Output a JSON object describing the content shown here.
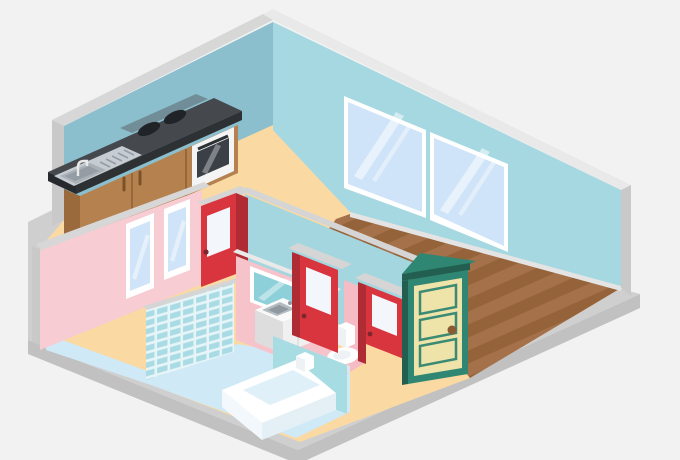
{
  "scene": {
    "description": "Isometric cutaway illustration of an apartment interior",
    "style": "flat vector isometric",
    "rooms": [
      {
        "name": "kitchen",
        "items": [
          "counter with steel sink and faucet",
          "two stove burners",
          "built-in oven",
          "brown cabinets"
        ]
      },
      {
        "name": "living-area",
        "items": [
          "hardwood plank floor",
          "double picture window"
        ]
      },
      {
        "name": "bathroom",
        "items": [
          "blue tiled accent wall",
          "bathtub",
          "toilet",
          "vanity sink cabinet",
          "wall mirror",
          "low partition wall",
          "two small windows"
        ]
      },
      {
        "name": "hallway",
        "items": [
          "red interior door 1",
          "red interior door 2",
          "red interior door 3",
          "green paneled entry door"
        ]
      }
    ]
  },
  "colors": {
    "bg": "#f2f2f2",
    "slab": "#cfcfcf",
    "slab_side": "#c1c1c1",
    "cap_left": "#d7d7d7",
    "cap_right": "#e9e9e9",
    "cut_gray": "#c9c9c9",
    "wall_left": "#8bbfcd",
    "wall_right": "#a5d8e1",
    "teal_wall": "#a3d6de",
    "partition": "#a8dce3",
    "floor_peach": "#fbd9a2",
    "wood": "#a4714a",
    "wood_dark": "#956339",
    "floor_blue": "#cfe9f6",
    "pink": "#f8ccd3",
    "pink2": "#f7c3cb",
    "pink_low": "#f5bcc5",
    "tile": "#a9dbe5",
    "grout": "#e7f5f8",
    "red": "#d8353f",
    "red_dark": "#b02c35",
    "door_cap": "#d5d5d5",
    "door_glass": "#f3f7fc",
    "white": "#ffffff",
    "glass": "#cfe4f8",
    "mirror_glass": "#8ed0d9",
    "green": "#2f8773",
    "green_dark": "#235f50",
    "cream": "#eee3a9",
    "panel_edge": "#3b8a74",
    "knob": "#8a5a33",
    "knob_red": "#7e262d",
    "counter_top": "#45494e",
    "counter_edge": "#2d3134",
    "counter_side": "#26292d",
    "counter_highlight": "#585d63",
    "cabinet": "#b5824f",
    "cabinet_side": "#9a6a3d",
    "seam": "#96683a",
    "handle": "#7a5129",
    "steel": "#c6ccd1",
    "steel_mid": "#a9b1b7",
    "steel_dark": "#949da4",
    "burner": "#202428",
    "oven": "#f4f4f4",
    "oven_win": "#3a4046",
    "tub_inner": "#dff0f8",
    "tub_sideL": "#f2f8fb",
    "tub_sideR": "#e4f0f6",
    "ceramic_mid": "#eef2f5",
    "ceramic_shadow": "#dfe6ea",
    "vanity_top": "#fafafa",
    "vanity_l": "#dddddd",
    "vanity_r": "#f0f0f0",
    "basin": "#8f989f",
    "basin_rim": "#b4bcc2",
    "baseboard": "#e4e4e4"
  }
}
